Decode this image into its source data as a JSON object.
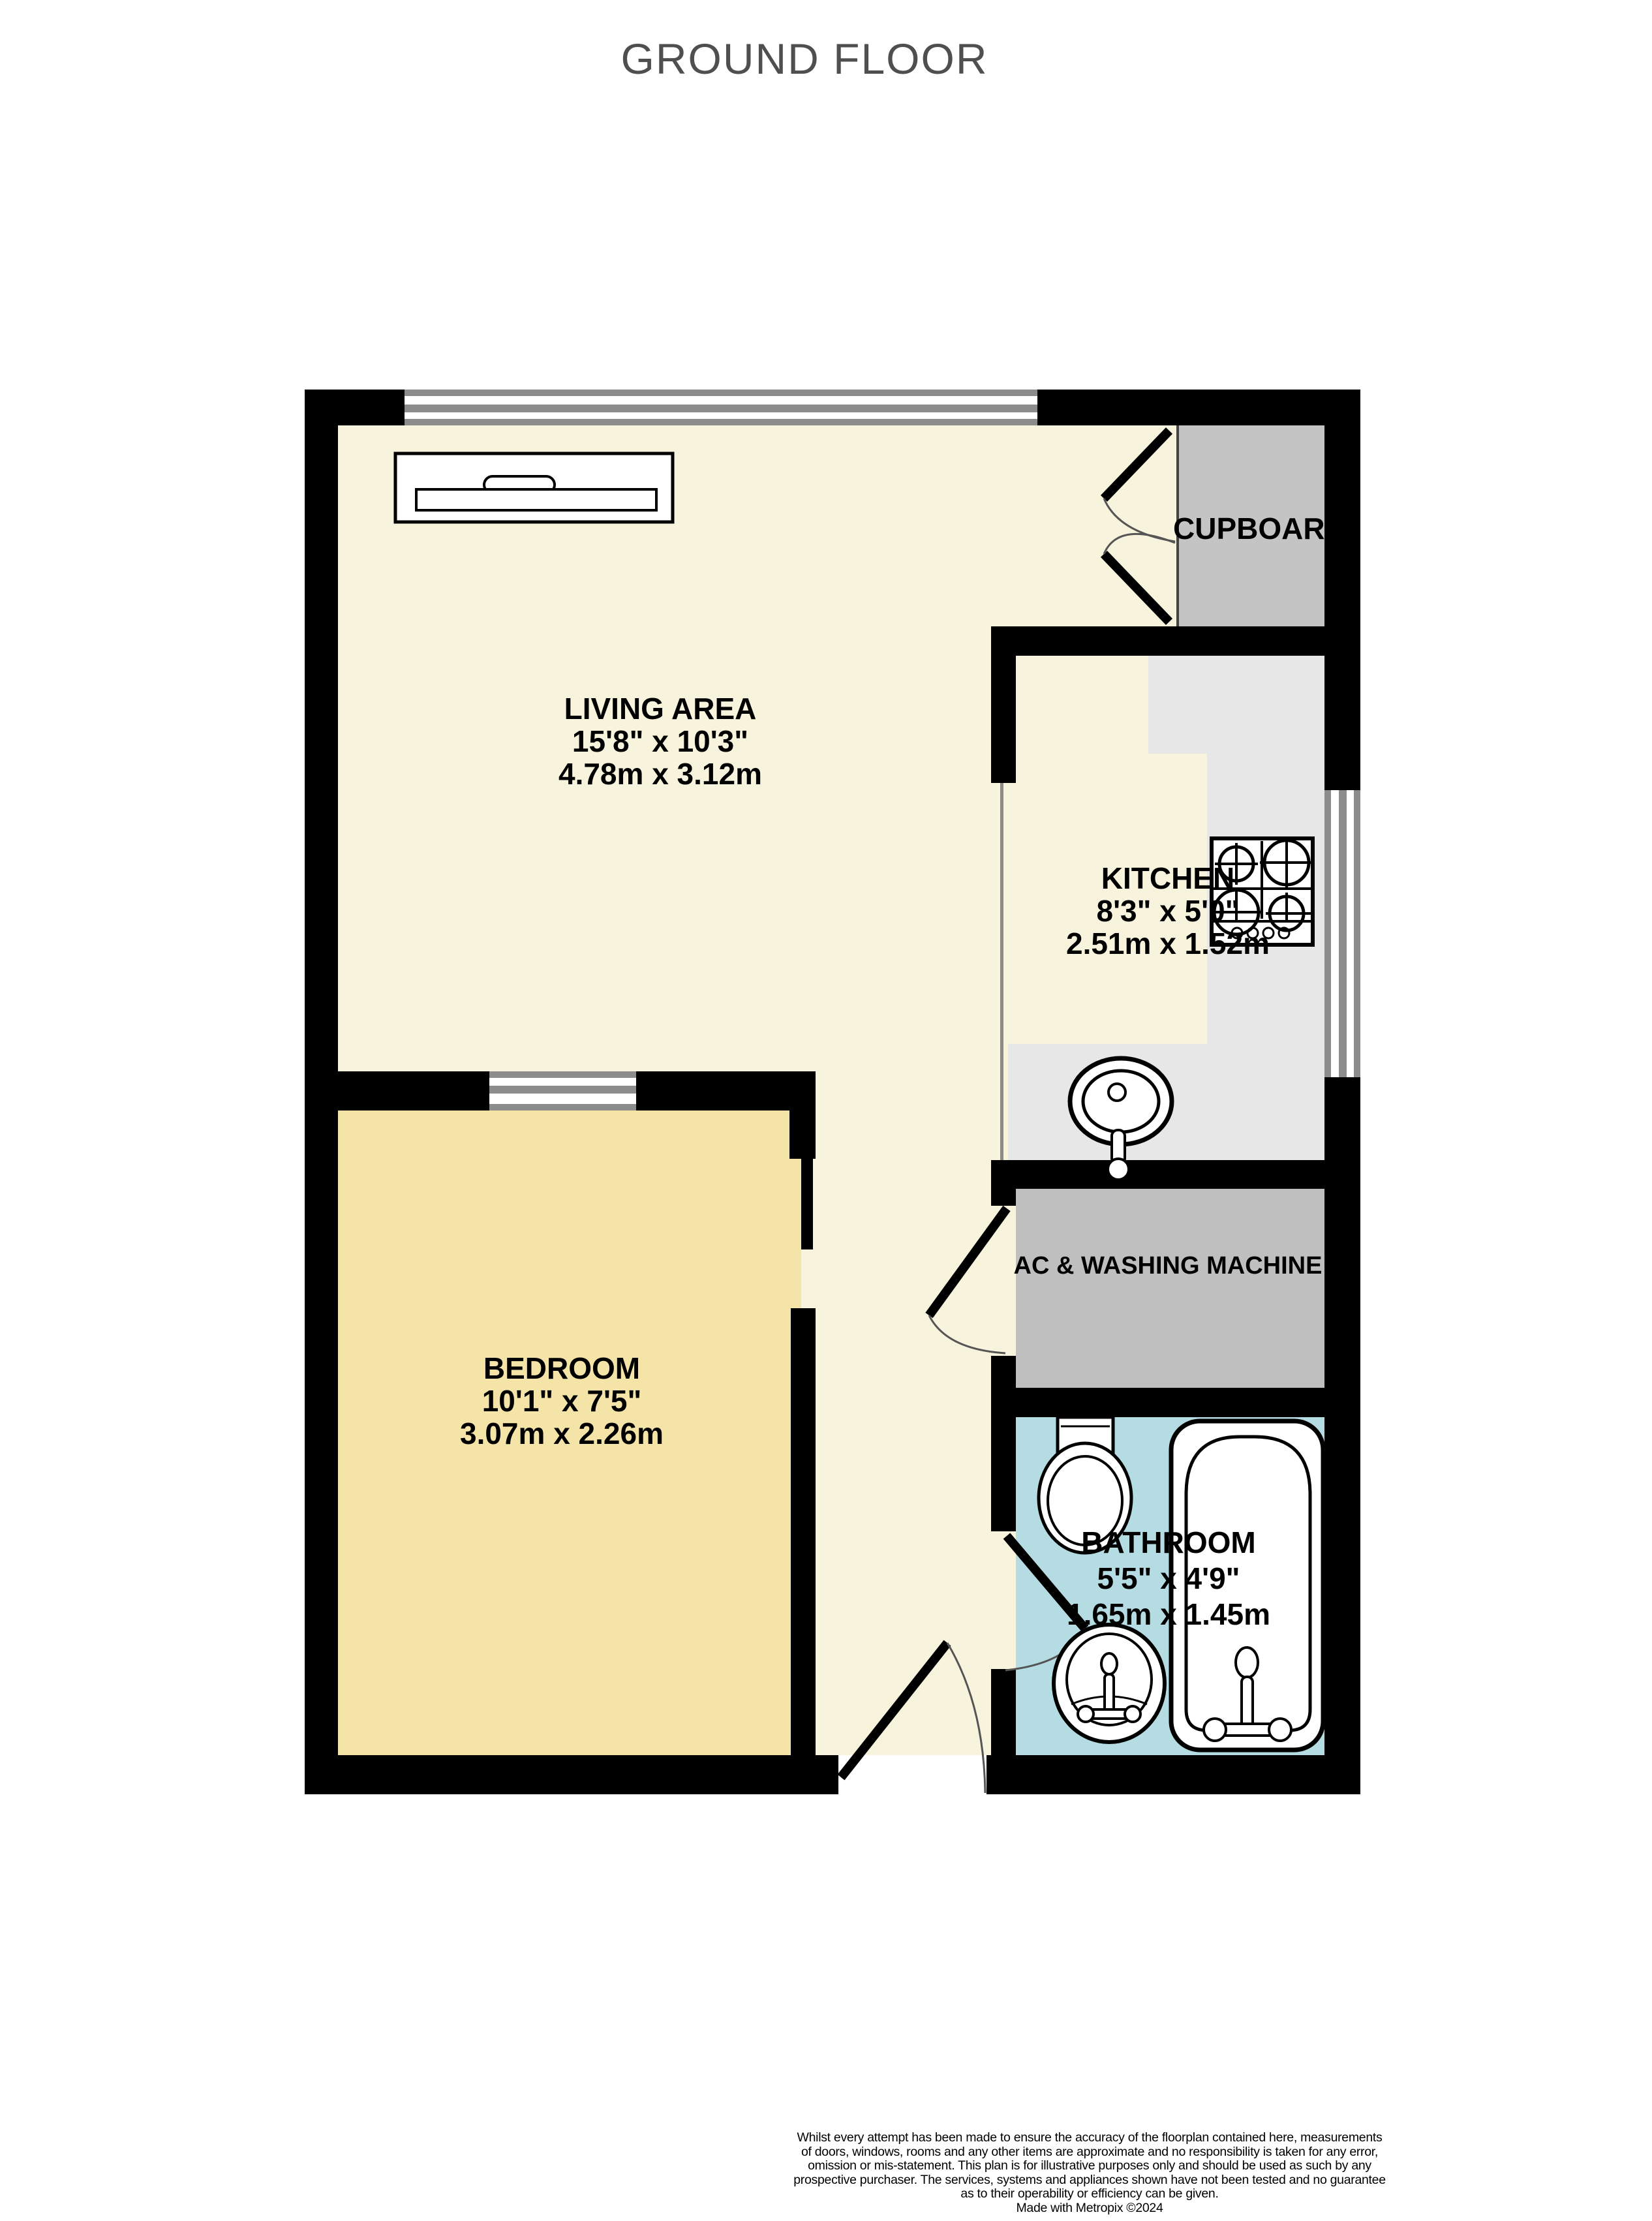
{
  "title": "GROUND FLOOR",
  "colors": {
    "wall": "#000000",
    "living": "#F8F3DC",
    "bedroom": "#F5E4A7",
    "kitchen_floor": "#E7E7E7",
    "cupboard": "#C4C4C4",
    "utility": "#BFBFBF",
    "bathroom": "#B5DBE3",
    "window_frame": "#8C8C8C",
    "door_arc": "#555555",
    "title_text": "#4F4F4F"
  },
  "rooms": {
    "living_area": {
      "name": "LIVING AREA",
      "imperial": "15'8\"  x 10'3\"",
      "metric": "4.78m  x 3.12m"
    },
    "kitchen": {
      "name": "KITCHEN",
      "imperial": "8'3\"  x 5'0\"",
      "metric": "2.51m  x 1.52m"
    },
    "cupboard": {
      "name": "CUPBOARD"
    },
    "bedroom": {
      "name": "BEDROOM",
      "imperial": "10'1\"  x 7'5\"",
      "metric": "3.07m  x 2.26m"
    },
    "utility": {
      "name": "AC & WASHING MACHINE"
    },
    "bathroom": {
      "name": "BATHROOM",
      "imperial": "5'5\"  x 4'9\"",
      "metric": "1.65m  x 1.45m"
    }
  },
  "disclaimer": {
    "lines": [
      "Whilst every attempt has been made to ensure the accuracy of the floorplan contained here, measurements",
      "of doors, windows, rooms and any other items are approximate and no responsibility is taken for any error,",
      "omission or mis-statement. This plan is for illustrative purposes only and should be used as such by any",
      "prospective purchaser. The services, systems and appliances shown have not been tested and no guarantee",
      "as to their operability or efficiency can be given.",
      "Made with Metropix ©2024"
    ]
  }
}
